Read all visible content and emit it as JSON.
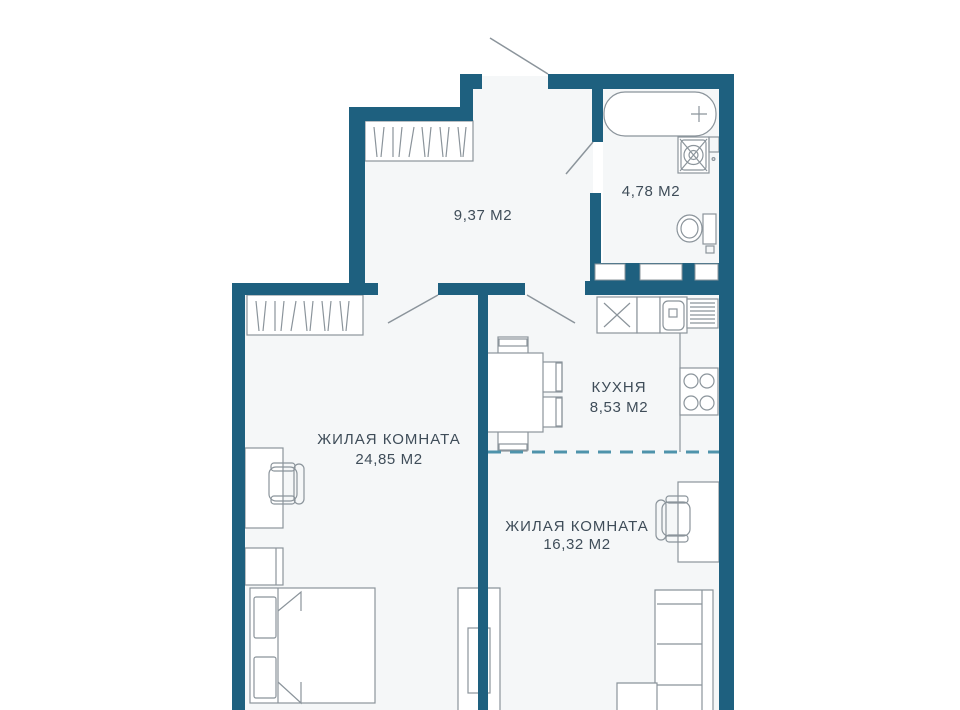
{
  "plan": {
    "type": "apartment-floorplan",
    "rooms": [
      {
        "id": "hallway",
        "name": "",
        "area_label": "9,37 М2"
      },
      {
        "id": "bathroom",
        "name": "",
        "area_label": "4,78 М2"
      },
      {
        "id": "kitchen",
        "name": "КУХНЯ",
        "area_label": "8,53 М2"
      },
      {
        "id": "living-room-1",
        "name": "ЖИЛАЯ КОМНАТА",
        "area_label": "24,85 М2"
      },
      {
        "id": "living-room-2",
        "name": "ЖИЛАЯ КОМНАТА",
        "area_label": "16,32 М2"
      }
    ],
    "colors": {
      "wall": "#1e607f",
      "floor": "#f5f7f8",
      "furniture_outline": "#8b949b",
      "label_text": "#3f4d59",
      "zone_divider_dash": "#4e93ab",
      "background": "#ffffff"
    },
    "furniture_icons": [
      "entry-door",
      "hall-wardrobe",
      "bathtub",
      "washing-machine",
      "toilet",
      "kitchen-hob-box",
      "kitchen-sink",
      "dish-rack",
      "stove-burners",
      "dining-table",
      "dining-chairs",
      "bedroom-wardrobe",
      "desk",
      "desk-chair",
      "dresser",
      "double-bed",
      "sofa",
      "side-table",
      "vent-shaft"
    ]
  }
}
